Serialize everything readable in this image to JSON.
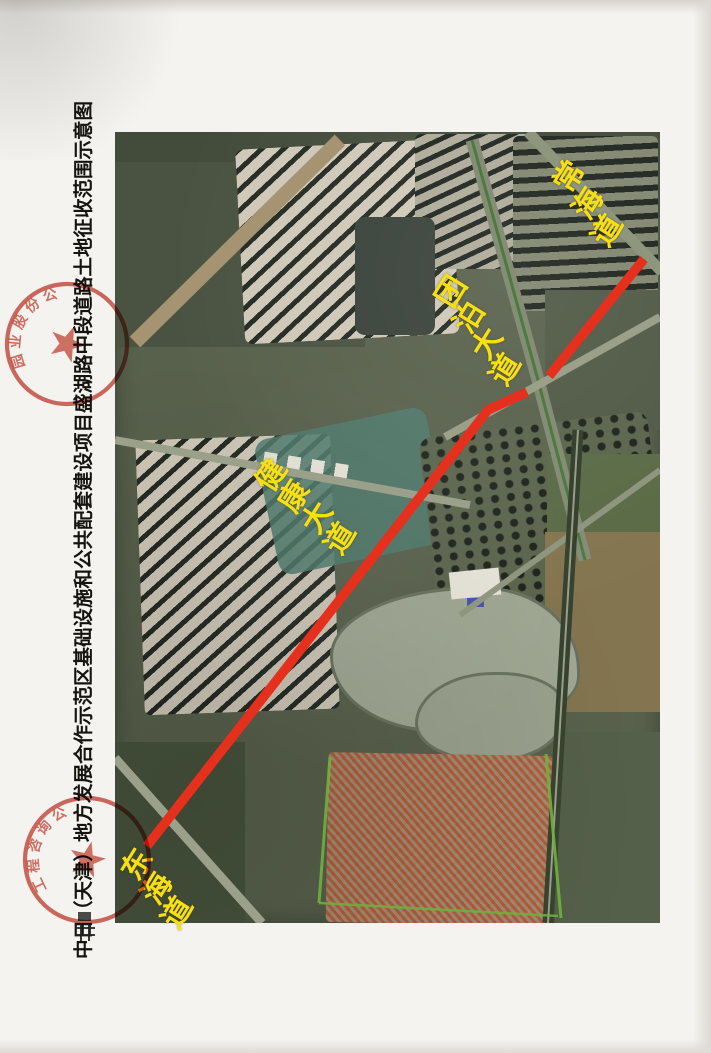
{
  "document_title": "中日（天津）地方发展合作示范区基础设施和公共配套建设项目盛湖路中段道路土地征收范围示意图",
  "map": {
    "label_color": "#f6e013",
    "road_labels": [
      {
        "text": "常海道",
        "x": 570,
        "y": 177,
        "dx": 19,
        "dy": 27,
        "rot": -58
      },
      {
        "text": "团泊大道",
        "x": 452,
        "y": 292,
        "dx": 18,
        "dy": 26,
        "rot": -58
      },
      {
        "text": "健康大道",
        "x": 272,
        "y": 476,
        "dx": 23,
        "dy": 21,
        "rot": -58
      },
      {
        "text": "东海道",
        "x": 138,
        "y": 865,
        "dx": 20,
        "dy": 24,
        "rot": -58
      }
    ],
    "route_line": {
      "color": "#e5301d",
      "width": 9.5,
      "segments": [
        [
          [
            644,
            259
          ],
          [
            549,
            376
          ]
        ],
        [
          [
            527,
            392
          ],
          [
            488,
            410
          ],
          [
            147,
            846
          ]
        ]
      ]
    }
  },
  "stamps": [
    {
      "cx": 67,
      "cy": 344,
      "r": 60,
      "rot": -50,
      "arc_text": "园业股份公",
      "color": "#c2392b"
    },
    {
      "cx": 87,
      "cy": 860,
      "r": 62,
      "rot": -58,
      "arc_text": "工程咨询公",
      "color": "#c2392b"
    }
  ]
}
